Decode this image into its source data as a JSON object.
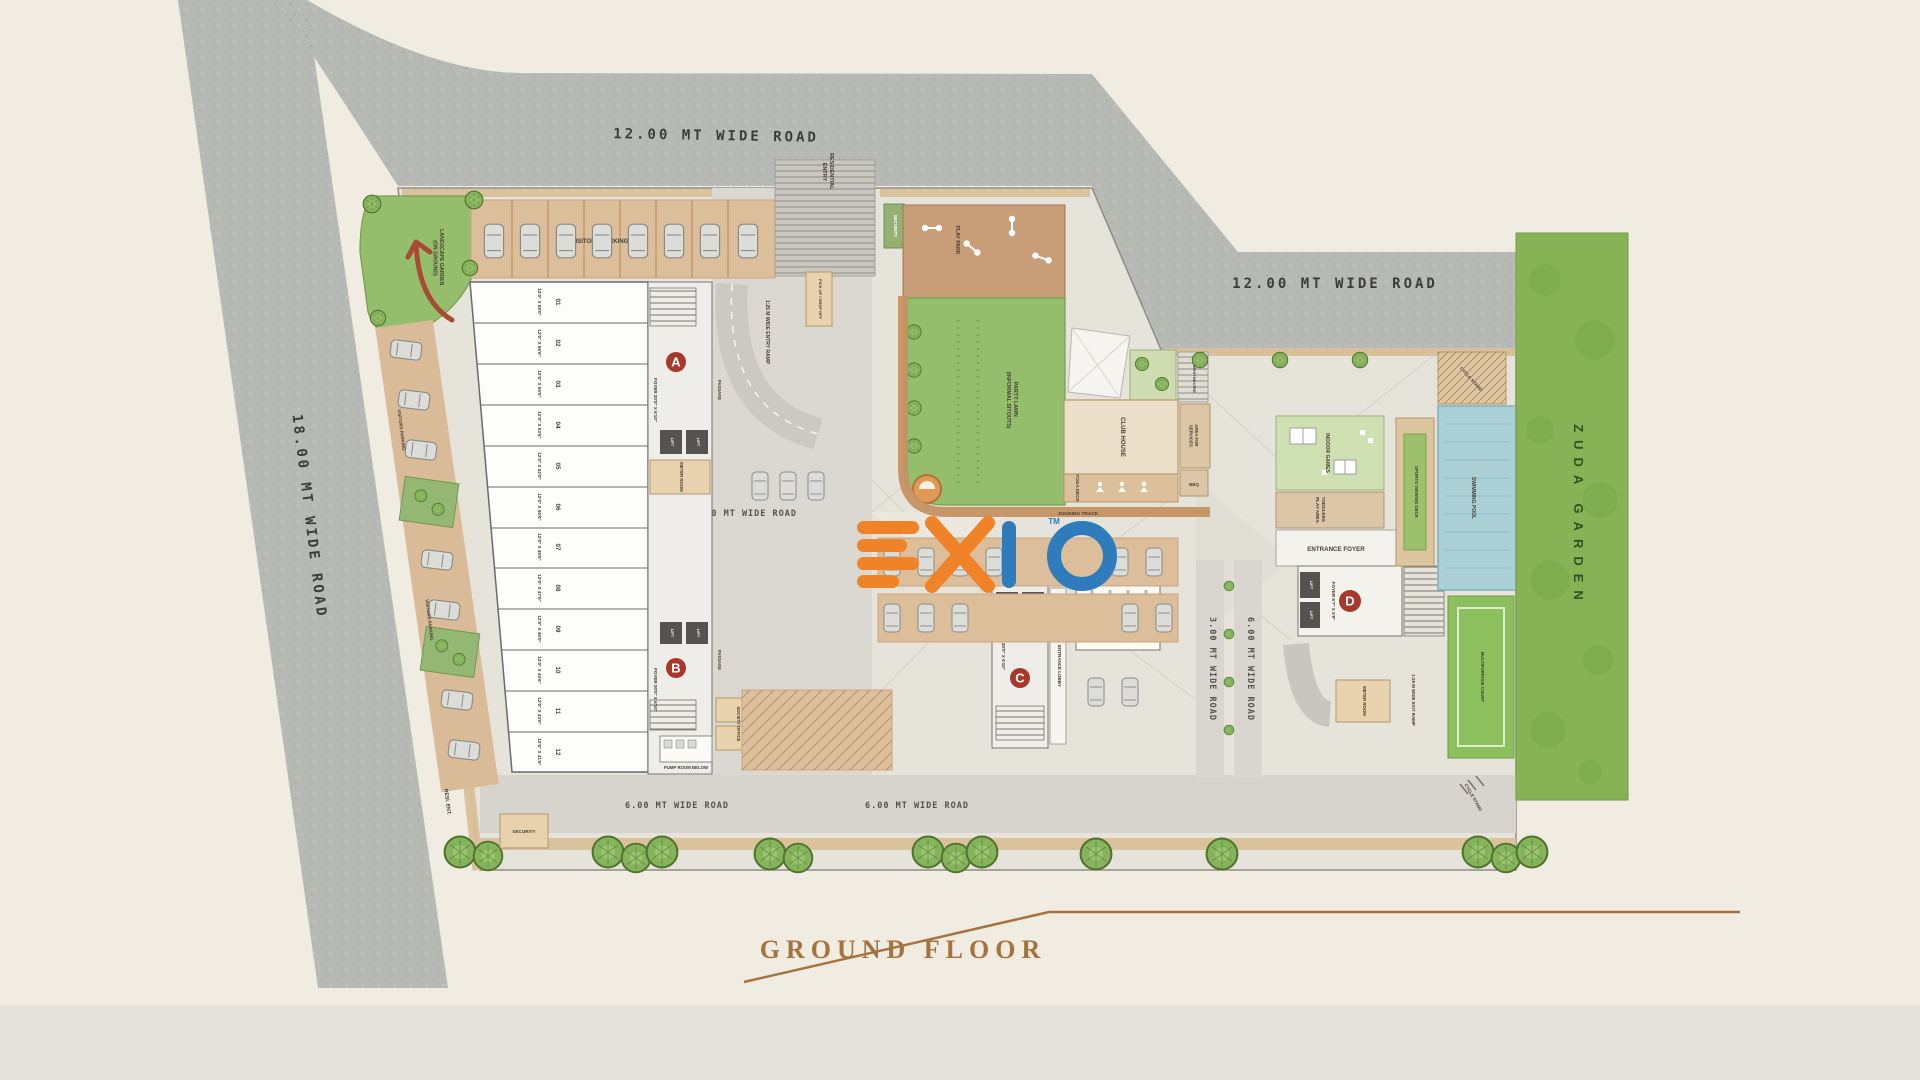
{
  "title": {
    "text": "GROUND FLOOR",
    "color": "#A5743E"
  },
  "branding": {
    "logo_text": "EXIO",
    "tm": "TM",
    "orange": "#F08228",
    "blue": "#2F7CBD"
  },
  "roads": {
    "top": "12.00 MT WIDE ROAD",
    "right": "12.00 MT WIDE ROAD",
    "left": "18.00 MT WIDE ROAD",
    "internal_9m": "9.00 MT WIDE ROAD",
    "internal_450": "4.50 MT WIDE ROAD",
    "bottom_6m_west": "6.00 MT WIDE ROAD",
    "bottom_6m_east": "6.00 MT WIDE ROAD",
    "lane_3m": "3.00 MT WIDE ROAD",
    "lane_6m": "6.00 MT WIDE ROAD"
  },
  "entries": {
    "residential_entry_l1": "RESIDENTIAL",
    "residential_entry_l2": "ENTRY",
    "resi_ent": "RESI. ENT.",
    "security_top": "SECURITY",
    "security_bottom": "SECURITY",
    "entry_ramp": "1:25 M WIDE ENTRY RAMP",
    "exit_ramp": "1:25 M WIDE EXIT RAMP",
    "pickup_drop": "PICK UP / DROP OFF"
  },
  "parking": {
    "visitors_top": "VISITORS PARKING",
    "visitors_left_1": "VISITORS PARKING",
    "visitors_left_2": "VISITORS PARKING"
  },
  "amenities": {
    "landscape_l1": "LANDSCAPE GARDEN",
    "landscape_l2": "(ON GROUND)",
    "play_park": "PLAY PARK",
    "party_lawn_l1": "PARTY LAWN",
    "party_lawn_l2": "(INFORMAL SITOUTS)",
    "club_house": "CLUB HOUSE",
    "amphitheatre": "AMPHITHEATRE",
    "services_l1": "AREA FOR",
    "services_l2": "SERVICES",
    "yoga_deck": "YOGA DECK",
    "bbq": "BBQ",
    "jogging_track": "JOGGING TRACK",
    "indoor_games": "INDOOR GAMES",
    "toddlers_l1": "TODDLERS",
    "toddlers_l2": "PLAY AREA",
    "entrance_foyer": "ENTRANCE FOYER",
    "entrance_lobby": "ENTRANCE LOBBY",
    "supermarket": "SUPERMARKET",
    "sports_viewing": "SPORTS VIEWING DECK",
    "swimming_pool": "SWIMMING POOL",
    "court": "MULTIPURPOSE COURT",
    "cycle_stand_top": "CYCLE STAND",
    "cycle_stand_bottom": "CYCLE STAND",
    "zuda_garden": "ZUDA GARDEN"
  },
  "rooms": {
    "meter_a": "METER ROOM",
    "meter_d": "METER ROOM",
    "society_office": "SOCIETY OFFICE",
    "pump_room": "PUMP ROOM BELOW",
    "passage": "PASSAGE",
    "lift": "LIFT",
    "up": "UP"
  },
  "towers": {
    "a": "A",
    "b": "B",
    "c": "C",
    "d": "D",
    "foyer_a": "FOYER 20'0\" X 6'10\"",
    "foyer_b": "FOYER 20'0\" X 6'10\"",
    "foyer_c": "FOYER 20'0\" X 6'10\"",
    "foyer_d": "FOYER 6'7\" X 5'9\""
  },
  "shops": [
    {
      "no": "01",
      "dim": "12'0\" X 58'0\""
    },
    {
      "no": "02",
      "dim": "12'0\" X 56'6\""
    },
    {
      "no": "03",
      "dim": "12'0\" X 55'0\""
    },
    {
      "no": "04",
      "dim": "12'0\" X 53'6\""
    },
    {
      "no": "05",
      "dim": "12'0\" X 52'0\""
    },
    {
      "no": "06",
      "dim": "12'0\" X 50'6\""
    },
    {
      "no": "07",
      "dim": "12'0\" X 49'0\""
    },
    {
      "no": "08",
      "dim": "12'0\" X 47'6\""
    },
    {
      "no": "09",
      "dim": "12'0\" X 46'0\""
    },
    {
      "no": "10",
      "dim": "12'0\" X 44'6\""
    },
    {
      "no": "11",
      "dim": "12'0\" X 43'0\""
    },
    {
      "no": "12",
      "dim": "12'0\" X 41'6\""
    }
  ]
}
